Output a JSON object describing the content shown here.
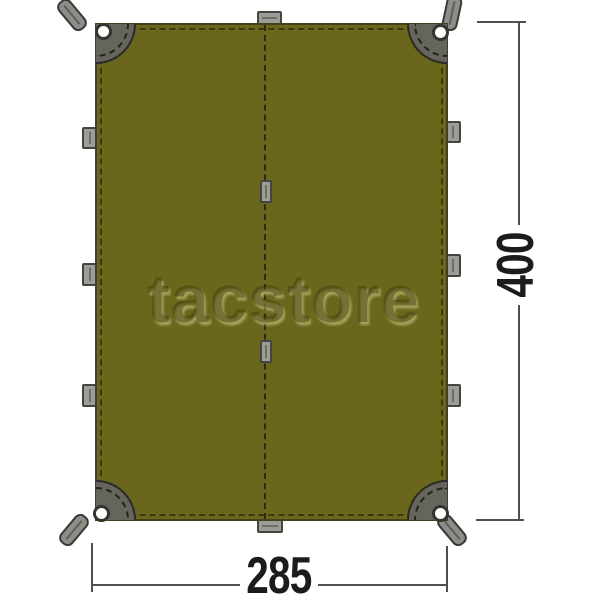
{
  "diagram": {
    "kind": "tarp-dimension-diagram",
    "watermark": "tacstore",
    "dimensions": {
      "width_label": "285",
      "height_label": "400"
    },
    "colors": {
      "background": "#ffffff",
      "tarp_fill": "#6a671d",
      "tarp_outline": "#45421a",
      "stitching": "#3a3715",
      "corner_patch": "#65655d",
      "hardware_gray": "#9d9d97",
      "strap_gray": "#8e8e88",
      "grommet_white": "#ffffff",
      "dimension_line": "#4f4f4f",
      "dimension_text": "#1c1c1a"
    },
    "hardware_counts": {
      "corner_grommets": 4,
      "corner_straps": 4,
      "left_edge_tabs": 3,
      "right_edge_tabs": 3,
      "top_edge_tabs": 1,
      "bottom_edge_tabs": 1,
      "center_seam_tabs": 2
    }
  }
}
